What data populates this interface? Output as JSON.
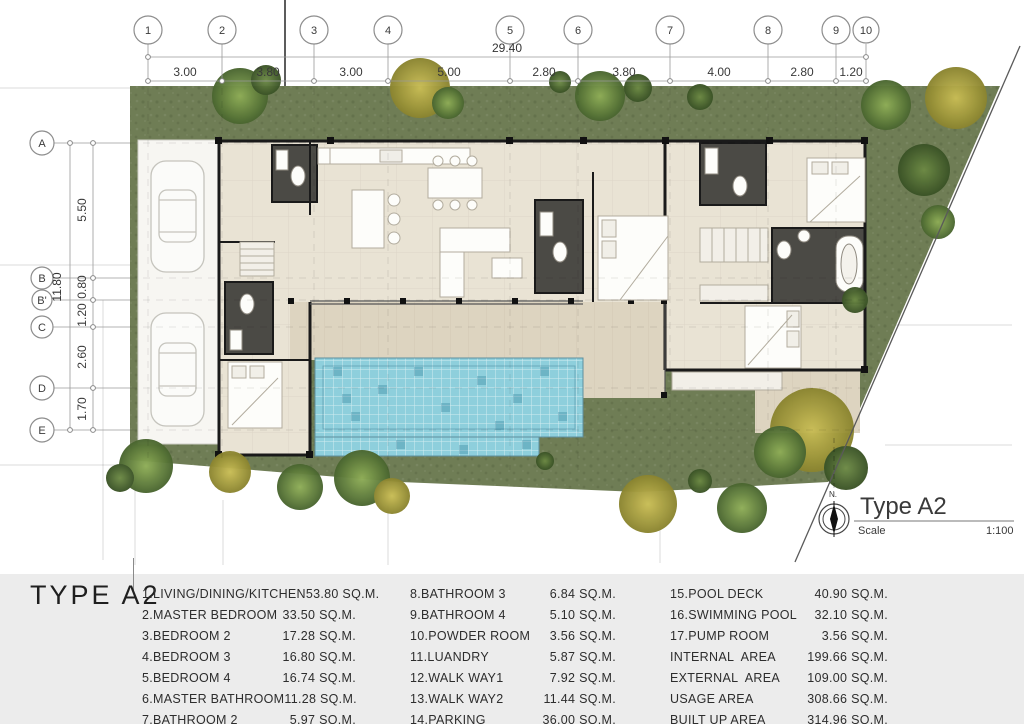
{
  "plan": {
    "title": "Type A2",
    "scale_label": "Scale",
    "scale_value": "1:100",
    "north_label": "N."
  },
  "grid": {
    "top": {
      "total": "29.40",
      "bubbles": [
        "1",
        "2",
        "3",
        "4",
        "5",
        "6",
        "7",
        "8",
        "9",
        "10"
      ],
      "segments": [
        "3.00",
        "3.80",
        "3.00",
        "5.00",
        "2.80",
        "3.80",
        "4.00",
        "2.80",
        "1.20"
      ]
    },
    "left": {
      "total": "11.80",
      "bubbles": [
        "A",
        "B",
        "B'",
        "C",
        "D",
        "E"
      ],
      "segments": [
        "5.50",
        "0.80",
        "1.20",
        "2.60",
        "1.70"
      ]
    }
  },
  "legend": {
    "heading": "TYPE A2",
    "columns": [
      {
        "rows": [
          {
            "label": "1.LIVING/DINING/KITCHEN",
            "value": "53.80 SQ.M."
          },
          {
            "label": "2.MASTER BEDROOM",
            "value": "33.50 SQ.M."
          },
          {
            "label": "3.BEDROOM 2",
            "value": "17.28 SQ.M."
          },
          {
            "label": "4.BEDROOM 3",
            "value": "16.80 SQ.M."
          },
          {
            "label": "5.BEDROOM 4",
            "value": "16.74 SQ.M."
          },
          {
            "label": "6.MASTER BATHROOM",
            "value": "11.28 SQ.M."
          },
          {
            "label": "7.BATHROOM 2",
            "value": "5.97 SQ.M."
          }
        ]
      },
      {
        "rows": [
          {
            "label": "8.BATHROOM 3",
            "value": "6.84 SQ.M."
          },
          {
            "label": "9.BATHROOM 4",
            "value": "5.10 SQ.M."
          },
          {
            "label": "10.POWDER ROOM",
            "value": "3.56 SQ.M."
          },
          {
            "label": "11.LUANDRY",
            "value": "5.87 SQ.M."
          },
          {
            "label": "12.WALK WAY1",
            "value": "7.92 SQ.M."
          },
          {
            "label": "13.WALK WAY2",
            "value": "11.44 SQ.M."
          },
          {
            "label": "14.PARKING",
            "value": "36.00 SQ.M."
          }
        ]
      },
      {
        "rows": [
          {
            "label": "15.POOL DECK",
            "value": "40.90 SQ.M."
          },
          {
            "label": "16.SWIMMING POOL",
            "value": "32.10 SQ.M."
          },
          {
            "label": "17.PUMP ROOM",
            "value": "3.56 SQ.M."
          },
          {
            "label": "INTERNAL  AREA",
            "value": "199.66 SQ.M."
          },
          {
            "label": "EXTERNAL  AREA",
            "value": "109.00 SQ.M."
          },
          {
            "label": "USAGE AREA",
            "value": "308.66 SQ.M."
          },
          {
            "label": "BUILT UP AREA",
            "value": "314.96 SQ.M."
          }
        ]
      }
    ]
  },
  "colors": {
    "grass": "#6f7d55",
    "floor": "#e9e3d4",
    "deck": "#ddd4c0",
    "pool": "#8ecfdc",
    "wall": "#1a1a1a",
    "bath_floor": "#4b4a45",
    "panel_bg": "#ececec"
  }
}
